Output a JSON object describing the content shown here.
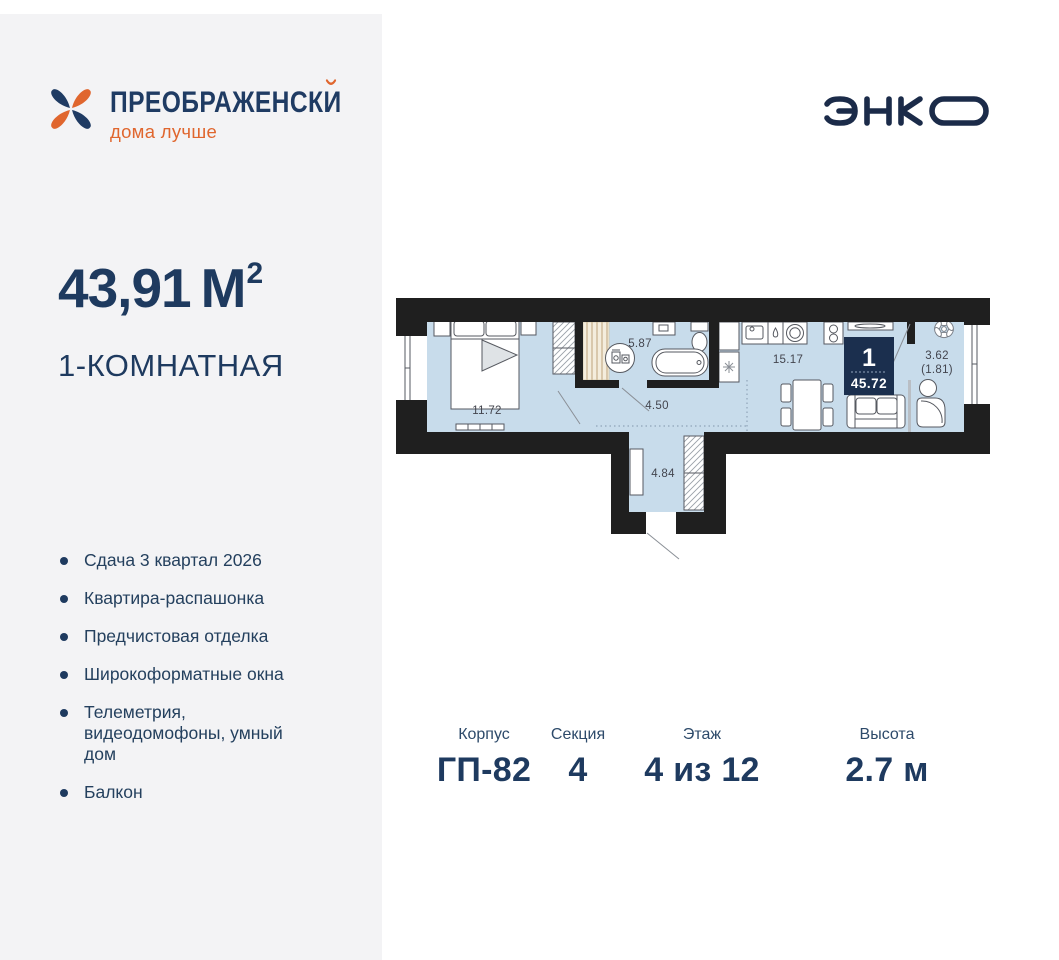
{
  "brand": {
    "name": "ПРЕОБРАЖЕНСКИЙ",
    "name_base": "ПРЕОБРАЖЕНСК",
    "name_last": "И",
    "tagline": "дома лучше"
  },
  "developer": {
    "name": "ЭНКО"
  },
  "listing": {
    "area": "43,91",
    "area_unit": "М",
    "area_sup": "2",
    "rooms_title": "1-КОМНАТНАЯ",
    "features": [
      "Сдача 3 квартал 2026",
      "Квартира-распашонка",
      "Предчистовая отделка",
      "Широкоформатные окна",
      "Телеметрия, видеодомофоны, умный дом",
      "Балкон"
    ]
  },
  "plan": {
    "badge": {
      "rooms": "1",
      "total_area": "45.72"
    },
    "rooms": [
      {
        "name": "bedroom",
        "area": "11.72"
      },
      {
        "name": "bathroom",
        "area": "5.87"
      },
      {
        "name": "hall",
        "area": "4.50"
      },
      {
        "name": "entry",
        "area": "4.84"
      },
      {
        "name": "kitchen-living",
        "area": "15.17"
      },
      {
        "name": "balcony",
        "area": "3.62",
        "area_reduced": "(1.81)"
      }
    ]
  },
  "specs": [
    {
      "label": "Корпус",
      "value": "ГП-82"
    },
    {
      "label": "Секция",
      "value": "4"
    },
    {
      "label": "Этаж",
      "value": "4 из 12"
    },
    {
      "label": "Высота",
      "value": "2.7 м"
    }
  ],
  "colors": {
    "navy": "#1e3a5f",
    "accent_orange": "#e0662e",
    "plan_fill": "#c8dceb",
    "wall": "#1f1f1f",
    "badge_navy": "#1b2f4e",
    "sidebar_bg": "#f3f3f5"
  }
}
